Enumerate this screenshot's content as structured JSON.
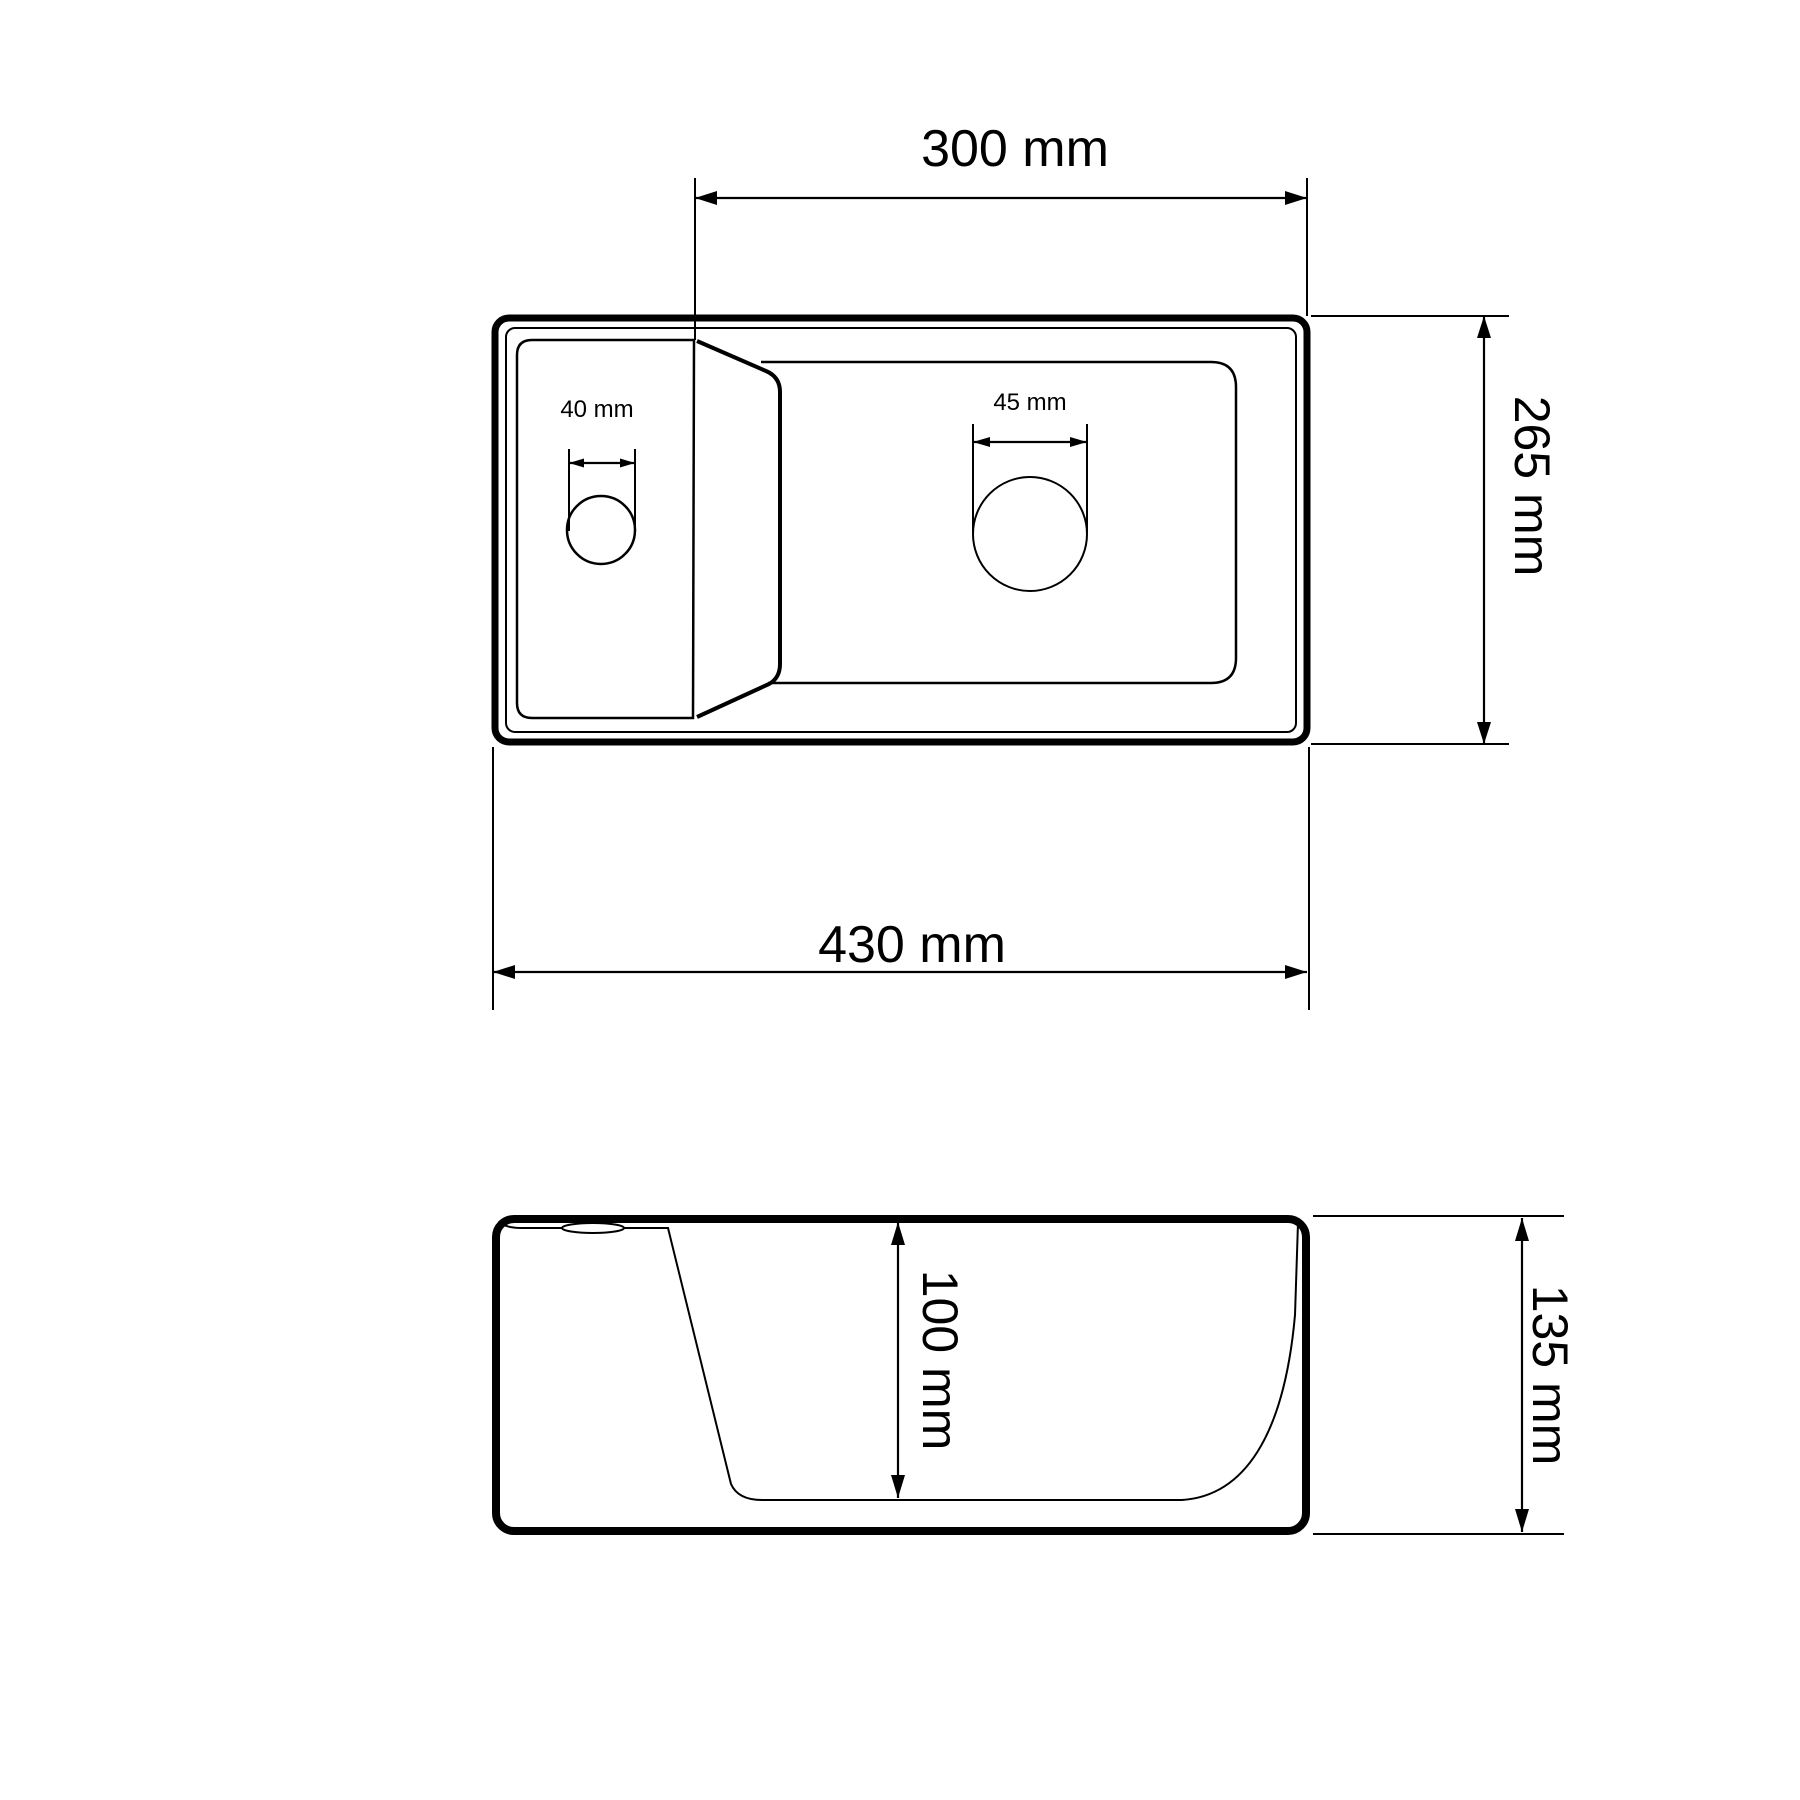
{
  "top_view": {
    "inner_width_label": "300 mm",
    "overall_width_label": "430 mm",
    "overall_depth_label": "265 mm",
    "tap_hole_label": "40 mm",
    "drain_hole_label": "45 mm"
  },
  "side_view": {
    "basin_depth_label": "100 mm",
    "overall_height_label": "135 mm"
  },
  "colors": {
    "line": "#000000",
    "background": "#ffffff"
  }
}
